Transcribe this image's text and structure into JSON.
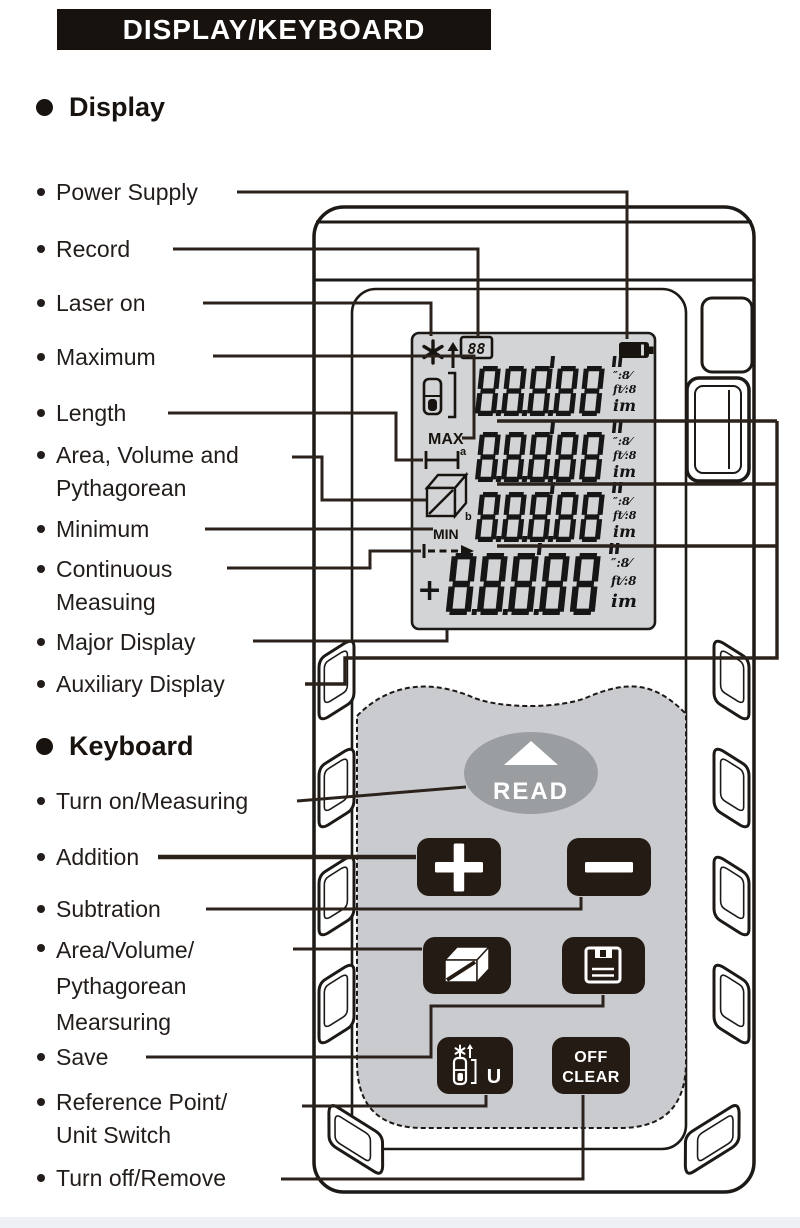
{
  "header": {
    "title": "DISPLAY/KEYBOARD"
  },
  "sections": {
    "display": {
      "heading": "Display",
      "labels": [
        {
          "id": "power-supply",
          "text": "Power Supply"
        },
        {
          "id": "record",
          "text": "Record"
        },
        {
          "id": "laser-on",
          "text": "Laser on"
        },
        {
          "id": "maximum",
          "text": "Maximum"
        },
        {
          "id": "length",
          "text": "Length"
        },
        {
          "id": "area-volume-pyth",
          "text": "Area, Volume and\nPythagorean"
        },
        {
          "id": "minimum",
          "text": "Minimum"
        },
        {
          "id": "continuous-measuring",
          "text": "Continuous\nMeasuing"
        },
        {
          "id": "major-display",
          "text": "Major Display"
        },
        {
          "id": "auxiliary-display",
          "text": "Auxiliary Display"
        }
      ]
    },
    "keyboard": {
      "heading": "Keyboard",
      "labels": [
        {
          "id": "turn-on-measuring",
          "text": "Turn on/Measuring"
        },
        {
          "id": "addition",
          "text": "Addition"
        },
        {
          "id": "subtraction",
          "text": "Subtration"
        },
        {
          "id": "area-volume-measure",
          "text": "Area/Volume/\nPythagorean\nMearsuring"
        },
        {
          "id": "save",
          "text": "Save"
        },
        {
          "id": "reference-unit",
          "text": "Reference Point/\nUnit Switch"
        },
        {
          "id": "turn-off-remove",
          "text": "Turn off/Remove"
        }
      ]
    }
  },
  "device": {
    "lcd": {
      "record_counter": "88",
      "rows": [
        {
          "digits": "88888"
        },
        {
          "digits": "88888"
        },
        {
          "digits": "88888"
        },
        {
          "digits": "88888"
        }
      ],
      "unit_stack": [
        "″:8⁄",
        "ft⁄:8",
        "im"
      ],
      "indicators": {
        "max": "MAX",
        "min": "MIN",
        "length_sup": "a",
        "volume_sub": "b",
        "plus": "+"
      },
      "icons": [
        "laser-star-icon",
        "up-arrow-icon",
        "record-counter-box",
        "battery-icon",
        "reference-point-icon",
        "length-icon",
        "area-volume-cube-icon",
        "continuous-measure-arrow-icon"
      ]
    },
    "buttons": {
      "read_label": "READ",
      "off_label": "OFF",
      "clear_label": "CLEAR",
      "unit_label": "U",
      "icons": {
        "plus": "plus-icon",
        "minus": "minus-icon",
        "area_volume": "cube-icon",
        "save": "floppy-disk-icon",
        "reference_unit": "laser-meter-star-icon"
      }
    }
  },
  "colors": {
    "ink": "#1c1916",
    "callout": "#2b221c",
    "button_dark": "#241b15",
    "lcd_bg": "#d3d4d6",
    "keypad_bg": "#c9cbce",
    "read_button": "#9b9ea1",
    "header_bg": "#17120e"
  }
}
